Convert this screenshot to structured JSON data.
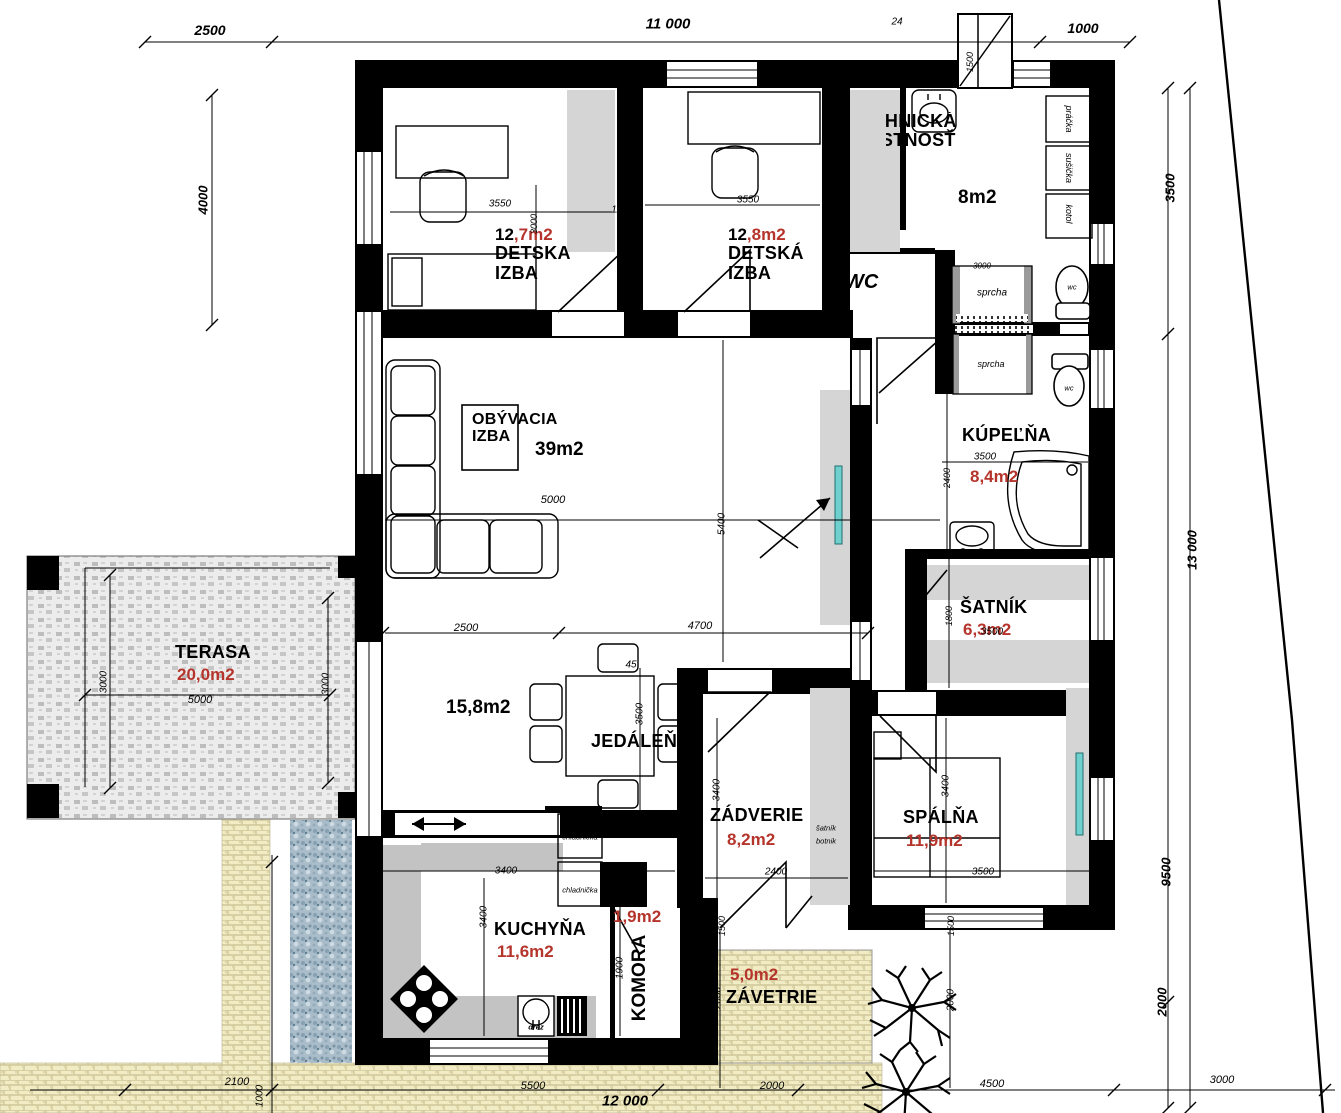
{
  "colors": {
    "wall": "#000000",
    "area_red": "#b5342b",
    "closet_gray": "#d5d5d5",
    "counter_gray": "#c3c3c3",
    "window_teal": "#6fd0ce",
    "paver_yellow": "#f1ecc3",
    "paver_gray": "#e6e6e6",
    "gravel_blue": "#a9bcc9"
  },
  "rooms": {
    "detska_izba_1": {
      "area_whole": "12",
      "area_decimal": ",7m2",
      "name_line1": "DETSKA",
      "name_line2": "IZBA"
    },
    "detska_izba_2": {
      "area_whole": "12",
      "area_decimal": ",8m2",
      "name_line1": "DETSKÁ",
      "name_line2": "IZBA"
    },
    "technicka_miestnost": {
      "name_line1": "TECHNICKÁ",
      "name_line2": "MIESTNOSŤ",
      "area": "8m2"
    },
    "wc_room": {
      "name": "WC"
    },
    "obyvacia_izba": {
      "name_line1": "OBÝVACIA",
      "name_line2": "IZBA",
      "area": "39m2"
    },
    "kupelna": {
      "name": "KÚPEĽŇA",
      "area": "8,4m2"
    },
    "satnik": {
      "name": "ŠATNÍK",
      "area": "6,3m2"
    },
    "terasa": {
      "name": "TERASA",
      "area": "20,0m2"
    },
    "jedalen": {
      "name": "JEDÁLEŇ",
      "area": "15,8m2"
    },
    "zadverie": {
      "name": "ZÁDVERIE",
      "area": "8,2m2"
    },
    "spalna": {
      "name": "SPÁLŇA",
      "area": "11,9m2"
    },
    "kuchyna": {
      "name": "KUCHYŇA",
      "area": "11,6m2"
    },
    "komora": {
      "name": "KOMORA",
      "area": "1,9m2"
    },
    "zavetrie": {
      "name": "ZÁVETRIE",
      "area": "5,0m2"
    }
  },
  "fixtures": {
    "pracka": "práčka",
    "susicka": "sušička",
    "kotol": "kotol",
    "sprcha_1": "sprcha",
    "sprcha_2": "sprcha",
    "wc_1": "wc",
    "wc_2": "wc",
    "chladnicka_1": "chladnička",
    "chladnicka_2": "chladnička",
    "drez": "drez",
    "satnik_botnik_line1": "šatník",
    "satnik_botnik_line2": "botnik"
  },
  "dimensions": [
    {
      "t": "2500",
      "x": 210,
      "y": 30,
      "s": 14,
      "b": 1
    },
    {
      "t": "11 000",
      "x": 668,
      "y": 24,
      "s": 15,
      "b": 1
    },
    {
      "t": "24",
      "x": 897,
      "y": 22,
      "s": 10
    },
    {
      "t": "1000",
      "x": 1083,
      "y": 28,
      "s": 14,
      "b": 1
    },
    {
      "t": "4000",
      "x": 203,
      "y": 200,
      "s": 13,
      "b": 1,
      "r": 1
    },
    {
      "t": "1500",
      "x": 970,
      "y": 62,
      "s": 9,
      "r": 1
    },
    {
      "t": "3500",
      "x": 1170,
      "y": 188,
      "s": 13,
      "b": 1,
      "r": 1
    },
    {
      "t": "13 000",
      "x": 1192,
      "y": 550,
      "s": 13,
      "b": 1,
      "r": 1
    },
    {
      "t": "9500",
      "x": 1166,
      "y": 872,
      "s": 13,
      "b": 1,
      "r": 1
    },
    {
      "t": "2000",
      "x": 1162,
      "y": 1002,
      "s": 13,
      "b": 1,
      "r": 1
    },
    {
      "t": "3000",
      "x": 1222,
      "y": 1080,
      "s": 11
    },
    {
      "t": "2100",
      "x": 237,
      "y": 1082,
      "s": 11
    },
    {
      "t": "5500",
      "x": 533,
      "y": 1086,
      "s": 11
    },
    {
      "t": "2000",
      "x": 772,
      "y": 1086,
      "s": 11
    },
    {
      "t": "4500",
      "x": 992,
      "y": 1084,
      "s": 11
    },
    {
      "t": "12 000",
      "x": 625,
      "y": 1101,
      "s": 15,
      "b": 1
    },
    {
      "t": "1000",
      "x": 260,
      "y": 1096,
      "s": 10,
      "r": 1
    },
    {
      "t": "3550",
      "x": 500,
      "y": 204,
      "s": 10
    },
    {
      "t": "3000",
      "x": 534,
      "y": 224,
      "s": 9,
      "r": 1
    },
    {
      "t": "1100",
      "x": 622,
      "y": 210,
      "s": 10
    },
    {
      "t": "3550",
      "x": 748,
      "y": 200,
      "s": 10
    },
    {
      "t": "3000",
      "x": 982,
      "y": 266,
      "s": 8
    },
    {
      "t": "5000",
      "x": 553,
      "y": 500,
      "s": 11
    },
    {
      "t": "5400",
      "x": 722,
      "y": 524,
      "s": 10,
      "r": 1
    },
    {
      "t": "2500",
      "x": 466,
      "y": 628,
      "s": 11
    },
    {
      "t": "4700",
      "x": 700,
      "y": 626,
      "s": 11
    },
    {
      "t": "45",
      "x": 631,
      "y": 665,
      "s": 10
    },
    {
      "t": "1000",
      "x": 947,
      "y": 360,
      "s": 9,
      "r": 1
    },
    {
      "t": "3500",
      "x": 985,
      "y": 457,
      "s": 10
    },
    {
      "t": "2400",
      "x": 947,
      "y": 478,
      "s": 9,
      "r": 1
    },
    {
      "t": "1800",
      "x": 949,
      "y": 616,
      "s": 9,
      "r": 1
    },
    {
      "t": "3500",
      "x": 992,
      "y": 632,
      "s": 10
    },
    {
      "t": "3400",
      "x": 717,
      "y": 790,
      "s": 10,
      "r": 1
    },
    {
      "t": "2400",
      "x": 776,
      "y": 872,
      "s": 10
    },
    {
      "t": "3400",
      "x": 946,
      "y": 786,
      "s": 10,
      "r": 1
    },
    {
      "t": "3500",
      "x": 983,
      "y": 872,
      "s": 10
    },
    {
      "t": "3500",
      "x": 640,
      "y": 714,
      "s": 10,
      "r": 1
    },
    {
      "t": "3400",
      "x": 506,
      "y": 871,
      "s": 10
    },
    {
      "t": "3400",
      "x": 484,
      "y": 917,
      "s": 10,
      "r": 1
    },
    {
      "t": "1900",
      "x": 620,
      "y": 968,
      "s": 10,
      "r": 1
    },
    {
      "t": "1500",
      "x": 722,
      "y": 926,
      "s": 9,
      "r": 1
    },
    {
      "t": "2000",
      "x": 718,
      "y": 998,
      "s": 10,
      "r": 1
    },
    {
      "t": "1500",
      "x": 951,
      "y": 926,
      "s": 9,
      "r": 1
    },
    {
      "t": "2000",
      "x": 951,
      "y": 1000,
      "s": 10,
      "r": 1
    },
    {
      "t": "3000",
      "x": 104,
      "y": 682,
      "s": 10,
      "r": 1
    },
    {
      "t": "3000",
      "x": 326,
      "y": 684,
      "s": 10,
      "r": 1
    },
    {
      "t": "5000",
      "x": 200,
      "y": 700,
      "s": 11
    }
  ]
}
